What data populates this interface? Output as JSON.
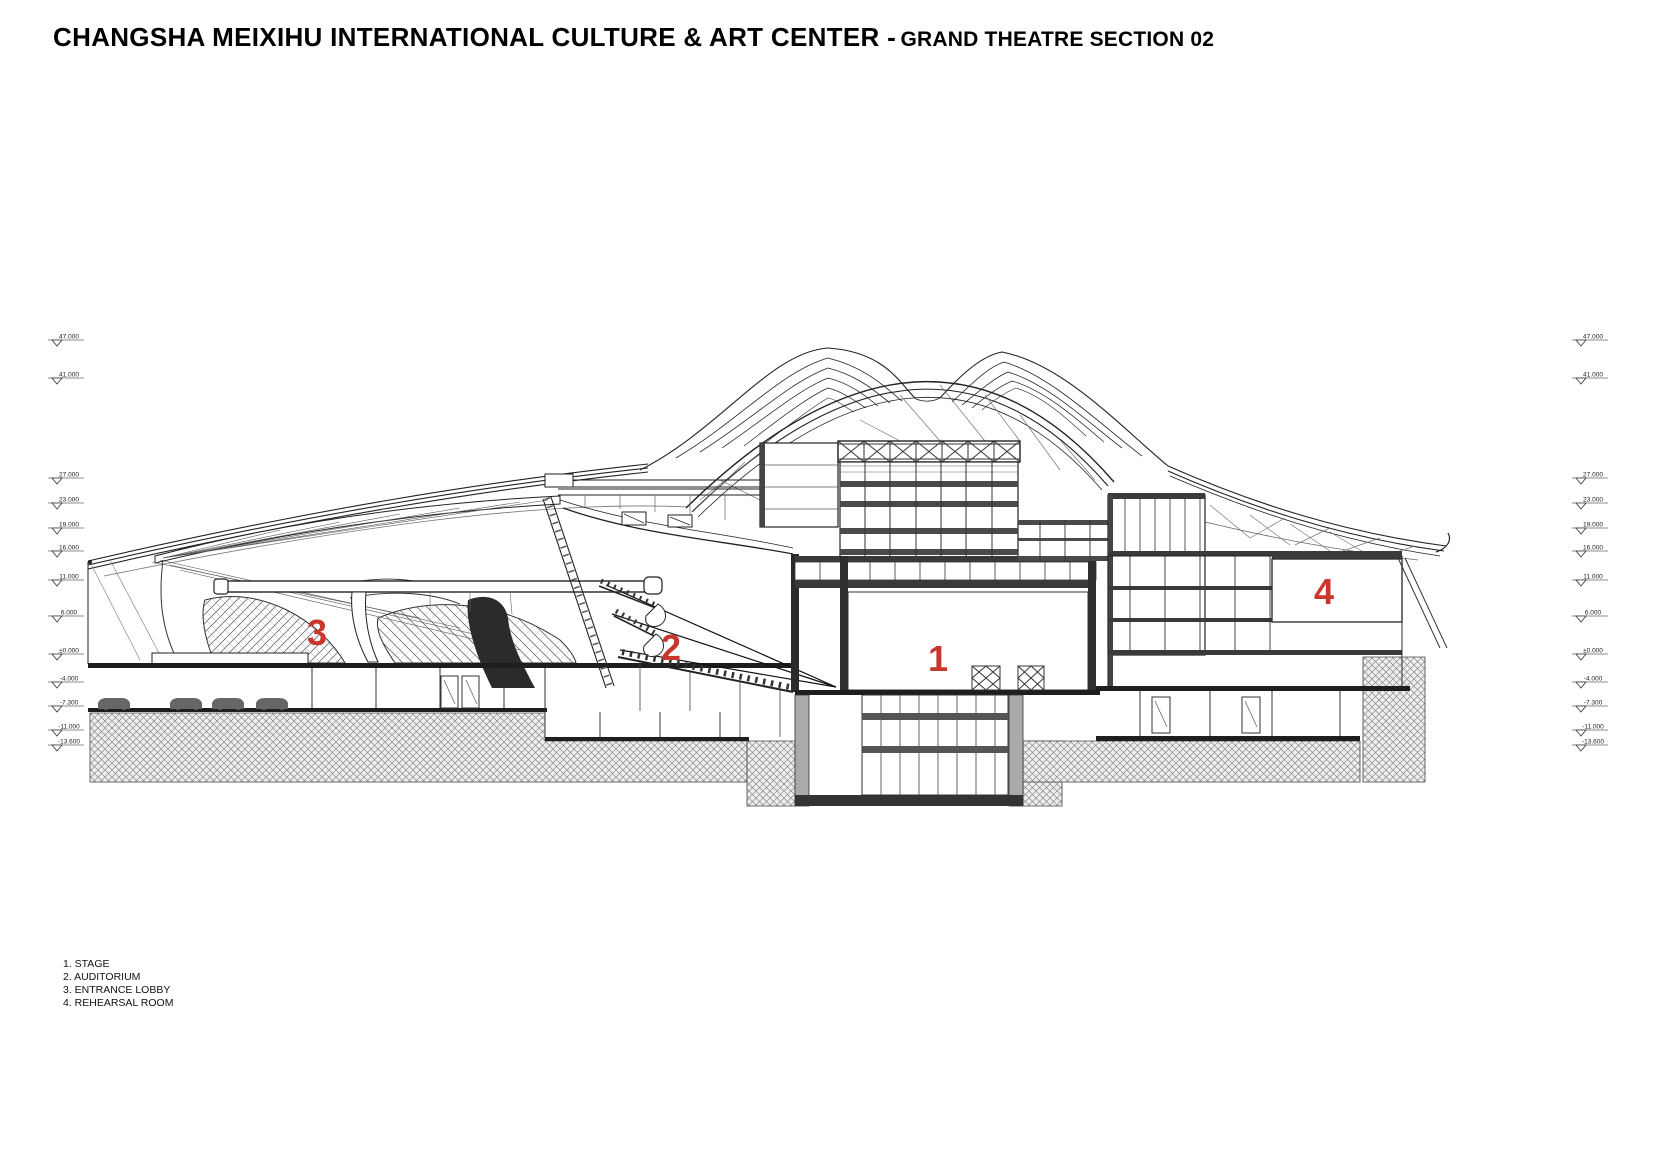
{
  "page": {
    "background": "#ffffff"
  },
  "header": {
    "title_main": "CHANGSHA MEIXIHU INTERNATIONAL CULTURE & ART CENTER -",
    "title_sub": "GRAND THEATRE SECTION 02"
  },
  "legend": {
    "items": [
      "1. STAGE",
      "2. AUDITORIUM",
      "3. ENTRANCE LOBBY",
      "4. REHEARSAL ROOM"
    ]
  },
  "room_labels": [
    {
      "number": "1",
      "name": "stage",
      "x": 938,
      "y": 671
    },
    {
      "number": "2",
      "name": "auditorium",
      "x": 671,
      "y": 660
    },
    {
      "number": "3",
      "name": "entrance-lobby",
      "x": 317,
      "y": 645
    },
    {
      "number": "4",
      "name": "rehearsal-room",
      "x": 1324,
      "y": 604
    }
  ],
  "elevation_markers": {
    "left_x": 48,
    "right_x": 1572,
    "values": [
      {
        "label": "47.000",
        "y": 340
      },
      {
        "label": "41.000",
        "y": 378
      },
      {
        "label": "27.000",
        "y": 478
      },
      {
        "label": "23.000",
        "y": 503
      },
      {
        "label": "19.000",
        "y": 528
      },
      {
        "label": "16.000",
        "y": 551
      },
      {
        "label": "11.000",
        "y": 580
      },
      {
        "label": "6.000",
        "y": 616
      },
      {
        "label": "±0.000",
        "y": 654
      },
      {
        "label": "-4.000",
        "y": 682
      },
      {
        "label": "-7.300",
        "y": 706
      },
      {
        "label": "-11.000",
        "y": 730
      },
      {
        "label": "-13.600",
        "y": 745
      }
    ]
  },
  "colors": {
    "accent_red": "#c8362e",
    "line": "#222222",
    "earth_line": "#8a8a8a"
  }
}
